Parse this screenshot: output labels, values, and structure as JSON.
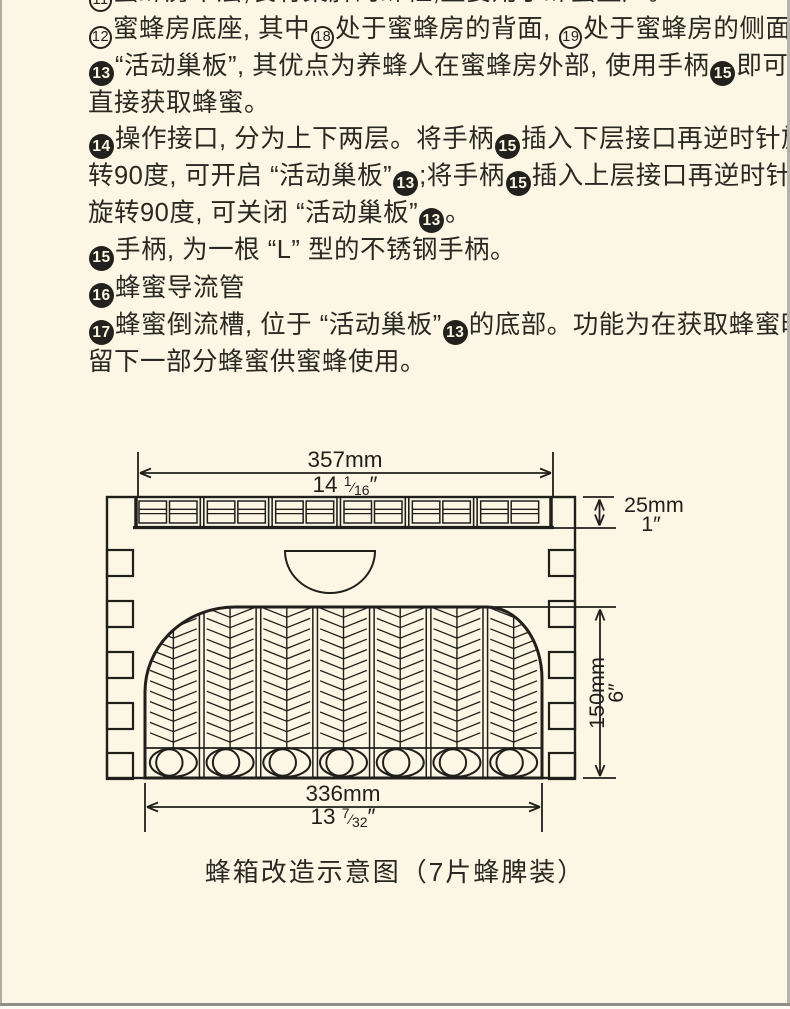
{
  "page": {
    "background": "#fbf7e4",
    "ink": "#201f1c"
  },
  "article": {
    "lines": [
      [
        [
          "o",
          "11"
        ],
        [
          "t",
          "蜜蜂房中层,装有巢脾的蜂框,主要用于蜂蜜生产。"
        ]
      ],
      [
        [
          "o",
          "12"
        ],
        [
          "t",
          "蜜蜂房底座, 其中"
        ],
        [
          "o",
          "18"
        ],
        [
          "t",
          "处于蜜蜂房的背面, "
        ],
        [
          "o",
          "19"
        ],
        [
          "t",
          "处于蜜蜂房的侧面。"
        ]
      ],
      [
        [
          "f",
          "13"
        ],
        [
          "t",
          "“活动巢板”, 其优点为养蜂人在蜜蜂房外部, 使用手柄"
        ],
        [
          "f",
          "15"
        ],
        [
          "t",
          "即可"
        ]
      ],
      [
        [
          "t",
          "直接获取蜂蜜。"
        ]
      ],
      [
        [
          "f",
          "14"
        ],
        [
          "t",
          "操作接口, 分为上下两层。将手柄"
        ],
        [
          "f",
          "15"
        ],
        [
          "t",
          "插入下层接口再逆时针旋"
        ]
      ],
      [
        [
          "t",
          "转90度, 可开启 “活动巢板”"
        ],
        [
          "f",
          "13"
        ],
        [
          "t",
          ";将手柄"
        ],
        [
          "f",
          "15"
        ],
        [
          "t",
          "插入上层接口再逆时针"
        ]
      ],
      [
        [
          "t",
          "旋转90度, 可关闭 “活动巢板”"
        ],
        [
          "f",
          "13"
        ],
        [
          "t",
          "。"
        ]
      ],
      [
        [
          "f",
          "15"
        ],
        [
          "t",
          "手柄, 为一根 “L” 型的不锈钢手柄。"
        ]
      ],
      [
        [
          "f",
          "16"
        ],
        [
          "t",
          "蜂蜜导流管"
        ]
      ],
      [
        [
          "f",
          "17"
        ],
        [
          "t",
          "蜂蜜倒流槽, 位于 “活动巢板”"
        ],
        [
          "f",
          "13"
        ],
        [
          "t",
          "的底部。功能为在获取蜂蜜时,"
        ]
      ],
      [
        [
          "t",
          "留下一部分蜂蜜供蜜蜂使用。"
        ]
      ]
    ]
  },
  "diagram": {
    "caption": "蜂箱改造示意图（7片蜂脾装）",
    "frame_count": 7,
    "top_strip_cell_groups": 6,
    "finger_notches_per_side": 5,
    "dimensions": {
      "width_top": {
        "mm": "357mm",
        "inch_whole": "14",
        "frac_num": "1",
        "frac_den": "16",
        "unit": "″"
      },
      "strip_height": {
        "mm": "25mm",
        "inch": "1″"
      },
      "body_height": {
        "mm": "150mm",
        "inch": "6″"
      },
      "width_bottom": {
        "mm": "336mm",
        "inch_whole": "13",
        "frac_num": "7",
        "frac_den": "32",
        "unit": "″"
      }
    }
  }
}
